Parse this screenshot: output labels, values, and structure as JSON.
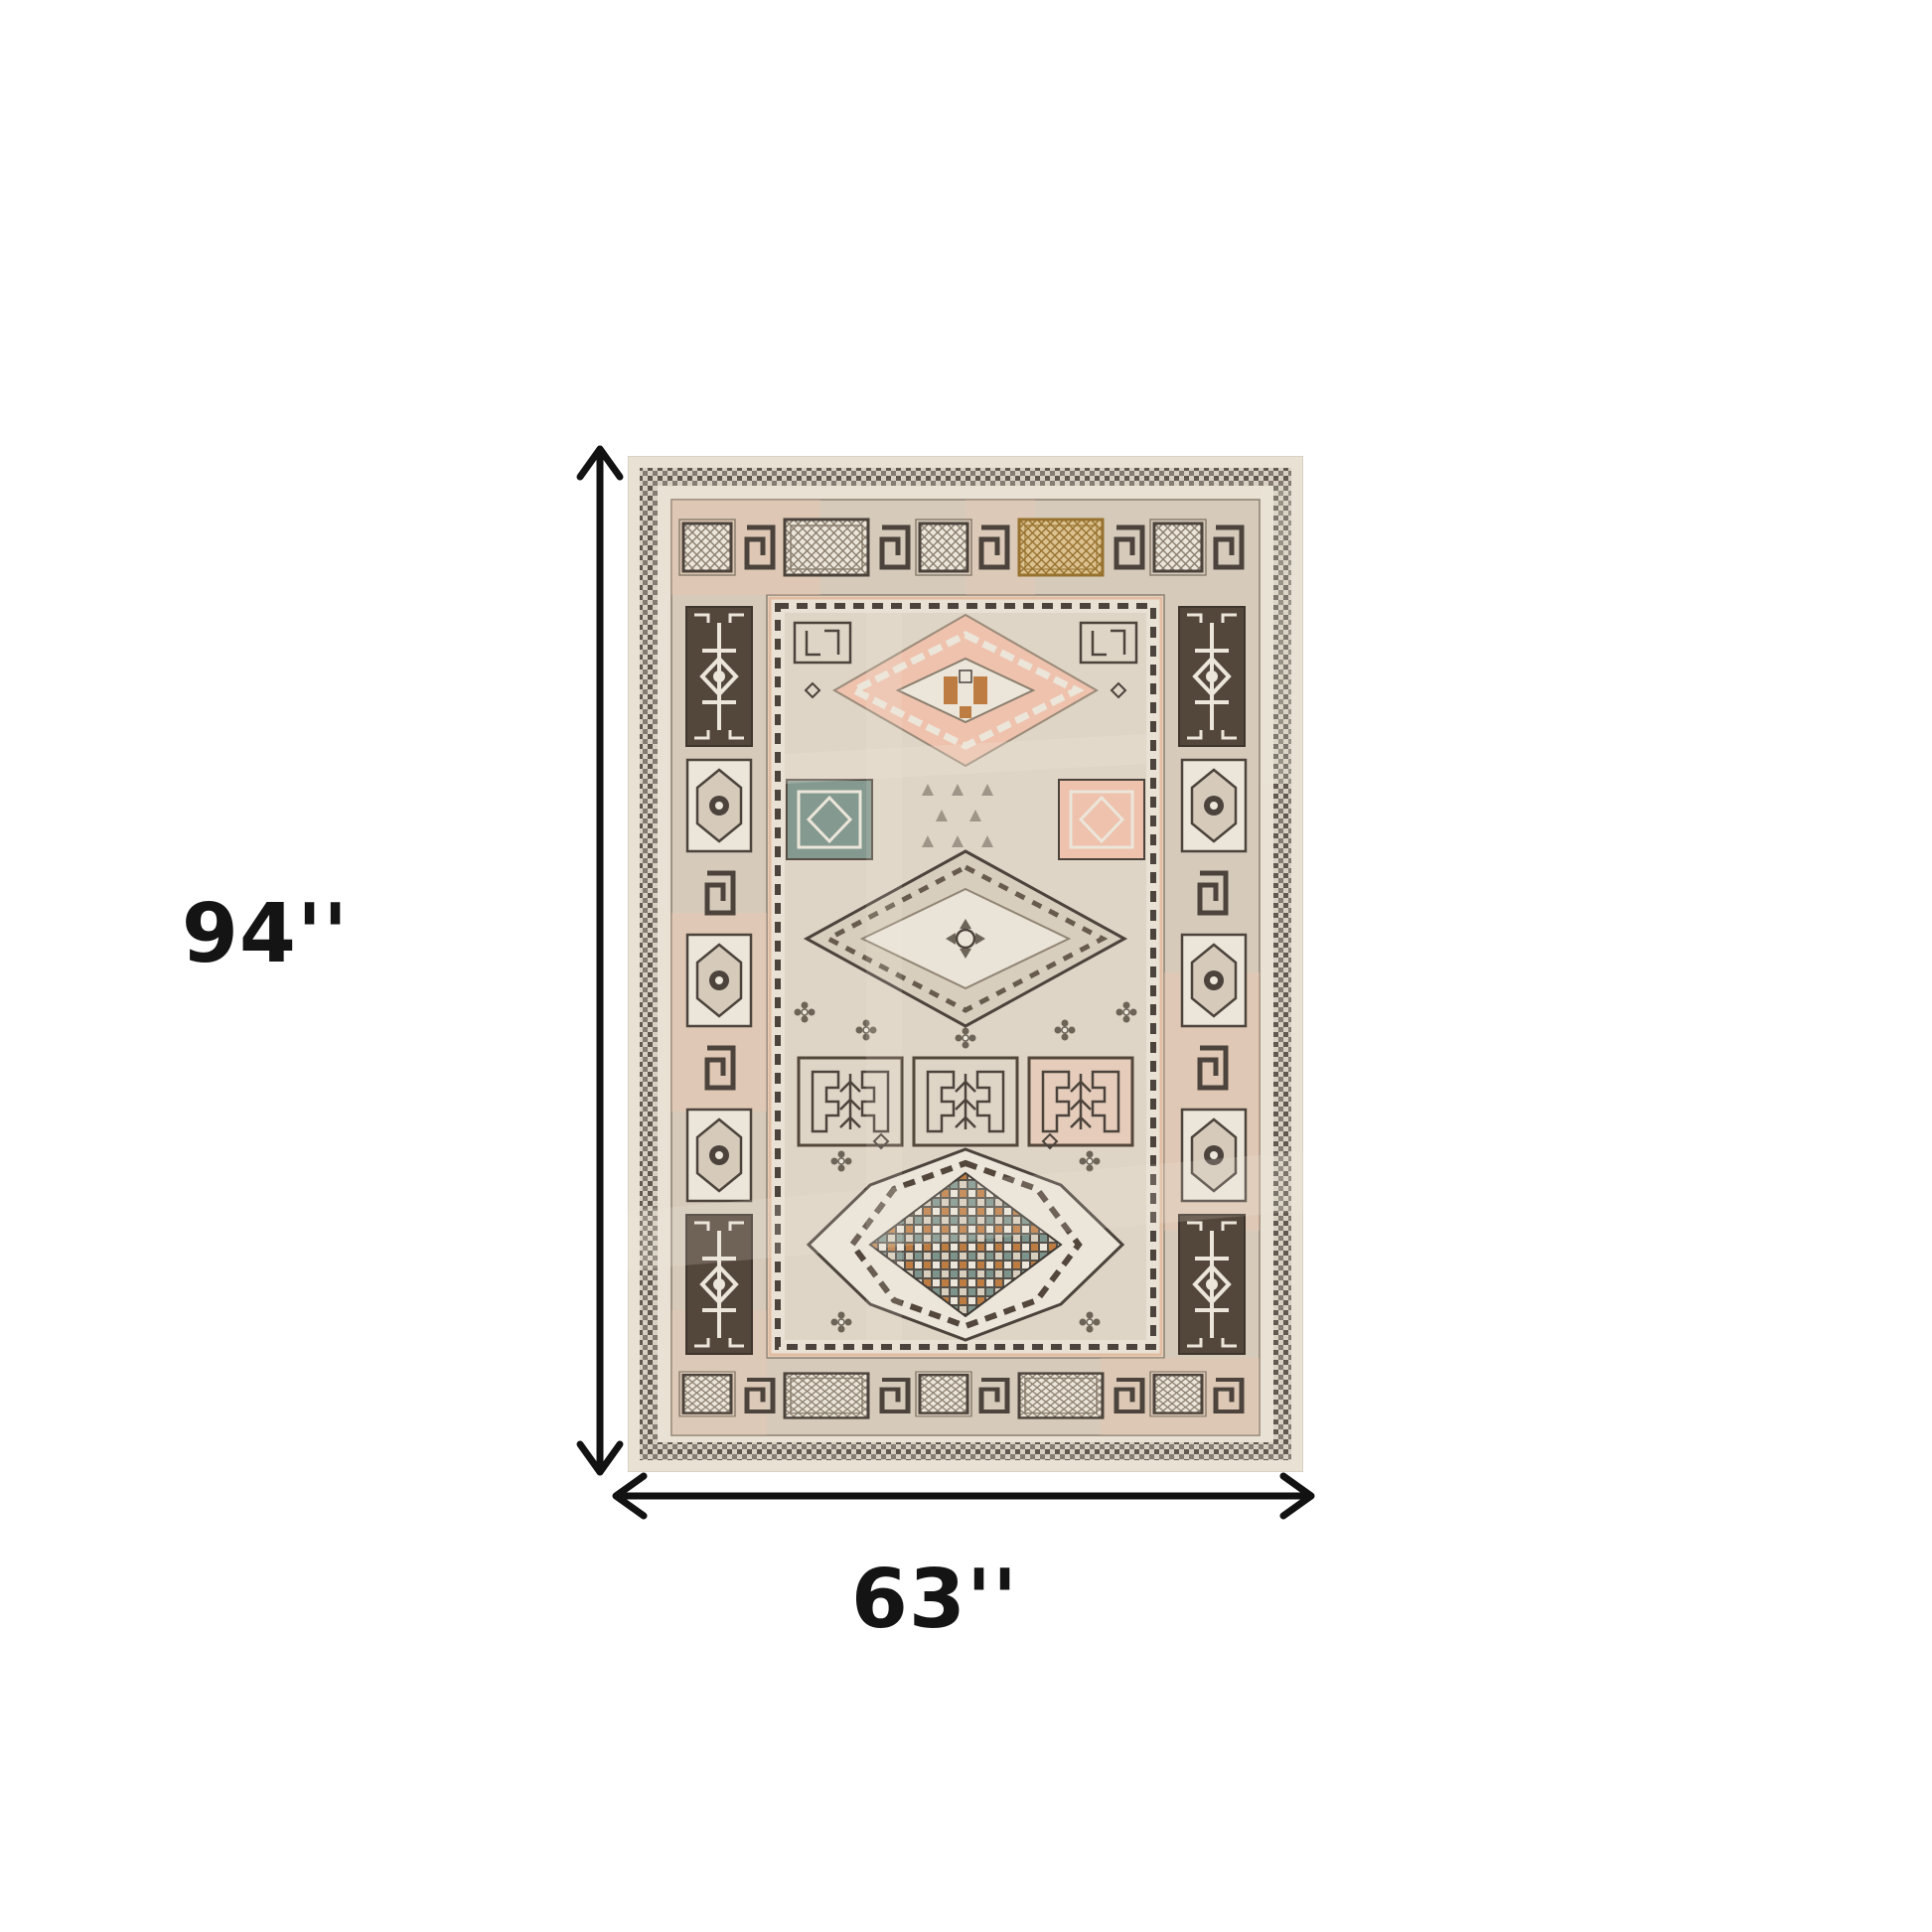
{
  "diagram": {
    "height_label": "94''",
    "width_label": "63''",
    "arrow_color": "#121212",
    "text_color": "#141414",
    "background": "#ffffff"
  },
  "rug": {
    "style": "distressed-tribal-medallion-rug",
    "palette": {
      "outer_cream": "#e8e1d4",
      "guard_bg": "#d8d0c2",
      "border_ground": "#d6cbbb",
      "field": "#ded5c6",
      "field2": "#d8cebe",
      "ivory": "#ece6da",
      "dark_brown": "#53463a",
      "charcoal": "#4c443c",
      "line_gray": "#8a7e6e",
      "salmon": "#eec2ad",
      "orange": "#bd7c41",
      "gold_bg": "#dcc291",
      "gold_line": "#97722f",
      "teal": "#7d948c",
      "checker_dark": "#55514a"
    }
  }
}
